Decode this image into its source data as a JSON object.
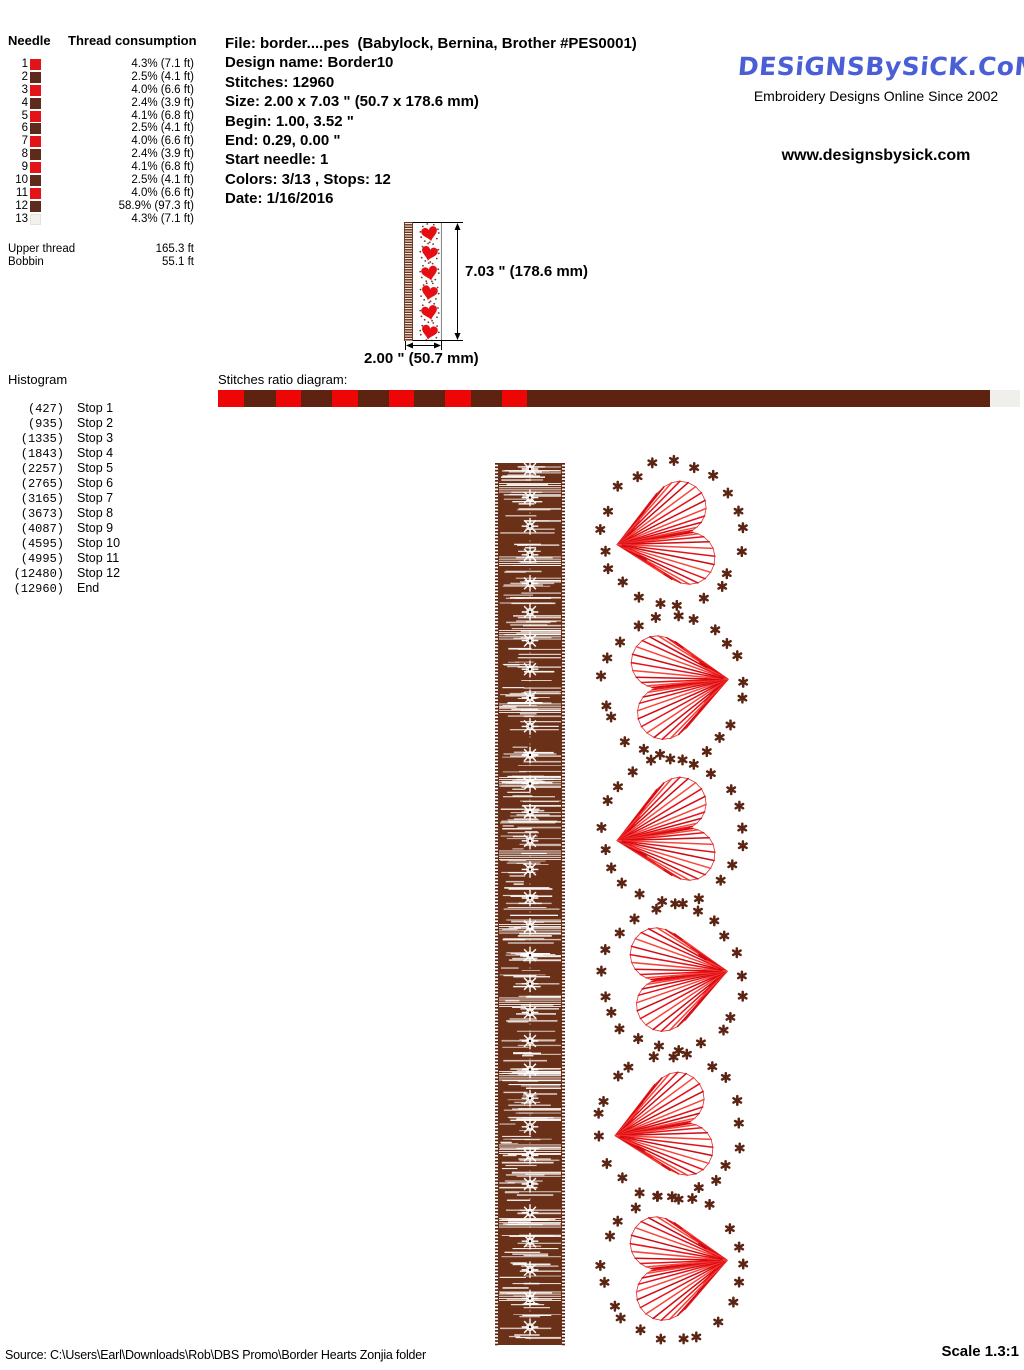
{
  "needle_table": {
    "header_needle": "Needle",
    "header_thread": "Thread consumption",
    "rows": [
      {
        "n": "1",
        "color": "#e31417",
        "value": "4.3% (7.1 ft)"
      },
      {
        "n": "2",
        "color": "#5d2a1c",
        "value": "2.5% (4.1 ft)"
      },
      {
        "n": "3",
        "color": "#e31417",
        "value": "4.0% (6.6 ft)"
      },
      {
        "n": "4",
        "color": "#5d2a1c",
        "value": "2.4% (3.9 ft)"
      },
      {
        "n": "5",
        "color": "#e31417",
        "value": "4.1% (6.8 ft)"
      },
      {
        "n": "6",
        "color": "#5d2a1c",
        "value": "2.5% (4.1 ft)"
      },
      {
        "n": "7",
        "color": "#e31417",
        "value": "4.0% (6.6 ft)"
      },
      {
        "n": "8",
        "color": "#5d2a1c",
        "value": "2.4% (3.9 ft)"
      },
      {
        "n": "9",
        "color": "#e31417",
        "value": "4.1% (6.8 ft)"
      },
      {
        "n": "10",
        "color": "#5d2a1c",
        "value": "2.5% (4.1 ft)"
      },
      {
        "n": "11",
        "color": "#e31417",
        "value": "4.0% (6.6 ft)"
      },
      {
        "n": "12",
        "color": "#5d2a1c",
        "value": "58.9% (97.3 ft)"
      },
      {
        "n": "13",
        "color": "#f2f1ec",
        "value": "4.3% (7.1 ft)"
      }
    ],
    "upper_thread_label": "Upper thread",
    "upper_thread_value": "165.3 ft",
    "bobbin_label": "Bobbin",
    "bobbin_value": "55.1 ft"
  },
  "file_info": {
    "lines": [
      "File: border....pes  (Babylock, Bernina, Brother #PES0001)",
      "Design name: Border10",
      "Stitches: 12960",
      "Size: 2.00 x 7.03 \" (50.7 x 178.6 mm)",
      "Begin: 1.00, 3.52 \"",
      "End: 0.29, 0.00 \"",
      "Start needle: 1",
      "Colors: 3/13 , Stops: 12",
      "Date: 1/16/2016"
    ]
  },
  "branding": {
    "logo_text": "DESiGNSBySiCK.CoM",
    "tagline": "Embroidery Designs Online Since 2002",
    "website": "www.designsbysick.com",
    "logo_color": "#4a5fd6"
  },
  "dimensions": {
    "height_label": "7.03 \" (178.6 mm)",
    "width_label": "2.00 \" (50.7 mm)"
  },
  "histogram": {
    "title": "Histogram",
    "rows": [
      {
        "count": "(427)",
        "label": "Stop 1"
      },
      {
        "count": "(935)",
        "label": "Stop 2"
      },
      {
        "count": "(1335)",
        "label": "Stop 3"
      },
      {
        "count": "(1843)",
        "label": "Stop 4"
      },
      {
        "count": "(2257)",
        "label": "Stop 5"
      },
      {
        "count": "(2765)",
        "label": "Stop 6"
      },
      {
        "count": "(3165)",
        "label": "Stop 7"
      },
      {
        "count": "(3673)",
        "label": "Stop 8"
      },
      {
        "count": "(4087)",
        "label": "Stop 9"
      },
      {
        "count": "(4595)",
        "label": "Stop 10"
      },
      {
        "count": "(4995)",
        "label": "Stop 11"
      },
      {
        "count": "(12480)",
        "label": "Stop 12"
      },
      {
        "count": "(12960)",
        "label": "End"
      }
    ]
  },
  "ratio_diagram": {
    "title": "Stitches ratio diagram:",
    "total_stitches": 12960,
    "segments": [
      {
        "stitches": 427,
        "color": "#ee0606"
      },
      {
        "stitches": 508,
        "color": "#5e2310"
      },
      {
        "stitches": 400,
        "color": "#ee0606"
      },
      {
        "stitches": 508,
        "color": "#5e2310"
      },
      {
        "stitches": 414,
        "color": "#ee0606"
      },
      {
        "stitches": 508,
        "color": "#5e2310"
      },
      {
        "stitches": 400,
        "color": "#ee0606"
      },
      {
        "stitches": 508,
        "color": "#5e2310"
      },
      {
        "stitches": 414,
        "color": "#ee0606"
      },
      {
        "stitches": 508,
        "color": "#5e2310"
      },
      {
        "stitches": 400,
        "color": "#ee0606"
      },
      {
        "stitches": 7485,
        "color": "#5e2310"
      },
      {
        "stitches": 480,
        "color": "#f0efeb"
      }
    ]
  },
  "design": {
    "strip": {
      "x": 495,
      "y": 463,
      "width": 70,
      "height": 882,
      "body_color": "#6b3118",
      "edge_color": "#5c2412",
      "flake_count": 31,
      "flake_spacing": 28.6
    },
    "hearts": [
      {
        "cx": 672,
        "cy": 535,
        "orient": "left"
      },
      {
        "cx": 673,
        "cy": 686,
        "orient": "right"
      },
      {
        "cx": 672,
        "cy": 831,
        "orient": "left"
      },
      {
        "cx": 672,
        "cy": 978,
        "orient": "right"
      },
      {
        "cx": 670,
        "cy": 1126,
        "orient": "left"
      },
      {
        "cx": 672,
        "cy": 1267,
        "orient": "right"
      }
    ],
    "heart_line_colors": [
      "#e8101a",
      "#cf0b12",
      "#fa4438"
    ],
    "dot_color": "#5c2412",
    "ring_rx": 70,
    "ring_ry": 72,
    "dots_per_ring": 21,
    "thumbnail": {
      "x": 404,
      "y": 222,
      "box_w": 37,
      "box_h": 119,
      "hearts": 6,
      "heart_color": "#e60d13"
    }
  },
  "footer": {
    "source": "Source: C:\\Users\\Earl\\Downloads\\Rob\\DBS Promo\\Border Hearts   Zonjia folder",
    "scale": "Scale 1.3:1"
  }
}
